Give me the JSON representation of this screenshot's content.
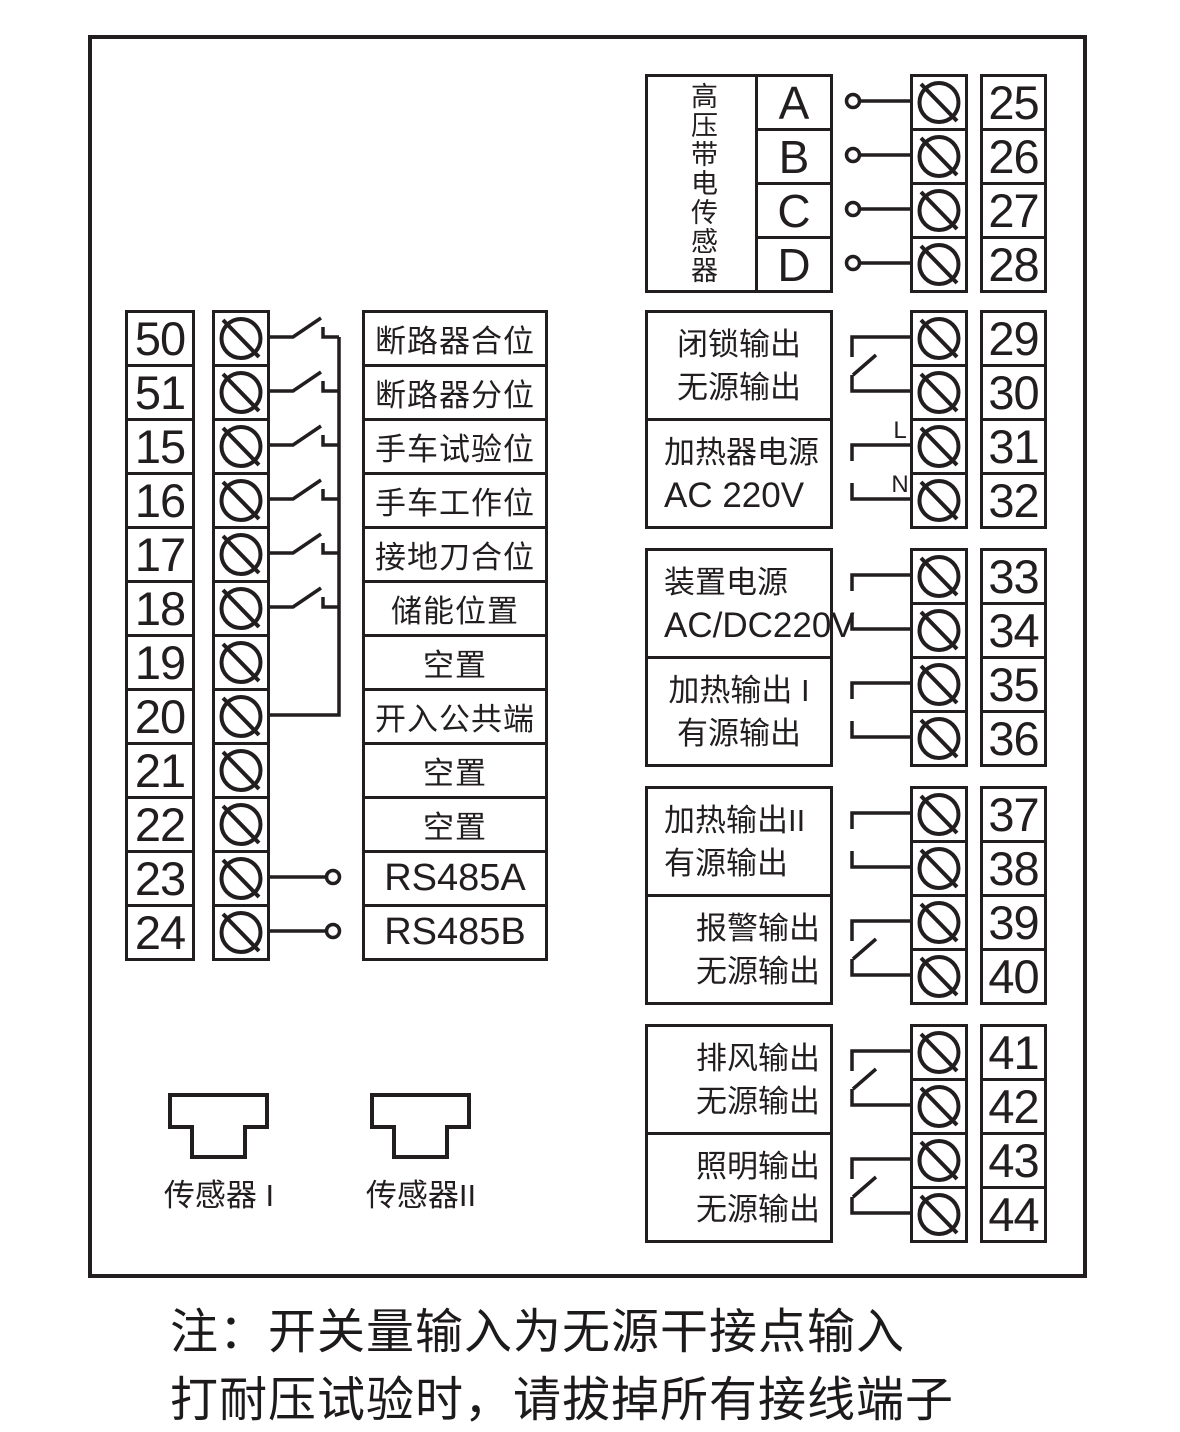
{
  "ink_color": "#221e1f",
  "left": {
    "rows": [
      {
        "terminal": "50",
        "label": "断路器合位",
        "connection": "switch"
      },
      {
        "terminal": "51",
        "label": "断路器分位",
        "connection": "switch"
      },
      {
        "terminal": "15",
        "label": "手车试验位",
        "connection": "switch"
      },
      {
        "terminal": "16",
        "label": "手车工作位",
        "connection": "switch"
      },
      {
        "terminal": "17",
        "label": "接地刀合位",
        "connection": "switch"
      },
      {
        "terminal": "18",
        "label": "储能位置",
        "connection": "switch"
      },
      {
        "terminal": "19",
        "label": "空置",
        "connection": "none"
      },
      {
        "terminal": "20",
        "label": "开入公共端",
        "connection": "common-bus"
      },
      {
        "terminal": "21",
        "label": "空置",
        "connection": "none"
      },
      {
        "terminal": "22",
        "label": "空置",
        "connection": "none"
      },
      {
        "terminal": "23",
        "label": "RS485A",
        "connection": "node"
      },
      {
        "terminal": "24",
        "label": "RS485B",
        "connection": "node"
      }
    ]
  },
  "hv_sensor": {
    "label": "高压带电传感器",
    "phases": [
      "A",
      "B",
      "C",
      "D"
    ],
    "terminals": [
      "25",
      "26",
      "27",
      "28"
    ]
  },
  "right": {
    "groups": [
      {
        "line1": "闭锁输出",
        "line2": "无源输出",
        "terminals": [
          "29",
          "30"
        ],
        "connection": "relay"
      },
      {
        "line1": "加热器电源",
        "line2": "AC 220V",
        "terminals": [
          "31",
          "32"
        ],
        "connection": "bracket",
        "tags": [
          "L",
          "N"
        ]
      },
      {
        "line1": "装置电源",
        "line2": "AC/DC220V",
        "terminals": [
          "33",
          "34"
        ],
        "connection": "bracket"
      },
      {
        "line1": "加热输出 I",
        "line2": "有源输出",
        "terminals": [
          "35",
          "36"
        ],
        "connection": "bracket"
      },
      {
        "line1": "加热输出II",
        "line2": "有源输出",
        "terminals": [
          "37",
          "38"
        ],
        "connection": "bracket"
      },
      {
        "line1": "报警输出",
        "line2": "无源输出",
        "terminals": [
          "39",
          "40"
        ],
        "connection": "relay"
      },
      {
        "line1": "排风输出",
        "line2": "无源输出",
        "terminals": [
          "41",
          "42"
        ],
        "connection": "relay"
      },
      {
        "line1": "照明输出",
        "line2": "无源输出",
        "terminals": [
          "43",
          "44"
        ],
        "connection": "relay"
      }
    ]
  },
  "connectors": {
    "sensor1": "传感器 I",
    "sensor2": "传感器II"
  },
  "note": {
    "line1": "注：开关量输入为无源干接点输入",
    "line2": "打耐压试验时，请拔掉所有接线端子"
  }
}
